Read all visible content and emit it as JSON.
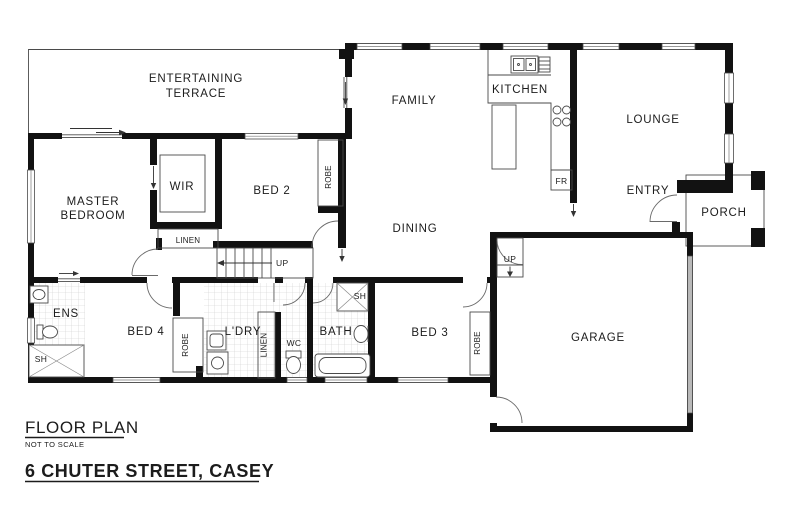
{
  "labels": {
    "terrace1": "ENTERTAINING",
    "terrace2": "TERRACE",
    "master1": "MASTER",
    "master2": "BEDROOM",
    "wir": "WIR",
    "bed2": "BED 2",
    "robe_bed2": "ROBE",
    "linen_hall": "LINEN",
    "up_stairs": "UP",
    "family": "FAMILY",
    "kitchen": "KITCHEN",
    "lounge": "LOUNGE",
    "dining": "DINING",
    "entry": "ENTRY",
    "porch": "PORCH",
    "fridge": "FR",
    "ens": "ENS",
    "shower_ens": "SH",
    "bed4": "BED 4",
    "robe_bed4": "ROBE",
    "laundry": "L'DRY",
    "linen_bath": "LINEN",
    "wc": "WC",
    "bath": "BATH",
    "shower_bath": "SH",
    "bed3": "BED 3",
    "robe_bed3": "ROBE",
    "garage": "GARAGE",
    "up_garage": "UP"
  },
  "title_block": {
    "title": "FLOOR PLAN",
    "scale_note": "NOT TO SCALE",
    "address": "6 CHUTER STREET, CASEY"
  },
  "colors": {
    "wall": "#121212",
    "thin_line": "#4a4a4a",
    "tile_line": "#cccccc",
    "garage_door": "#b9b9b9",
    "background": "#ffffff"
  }
}
